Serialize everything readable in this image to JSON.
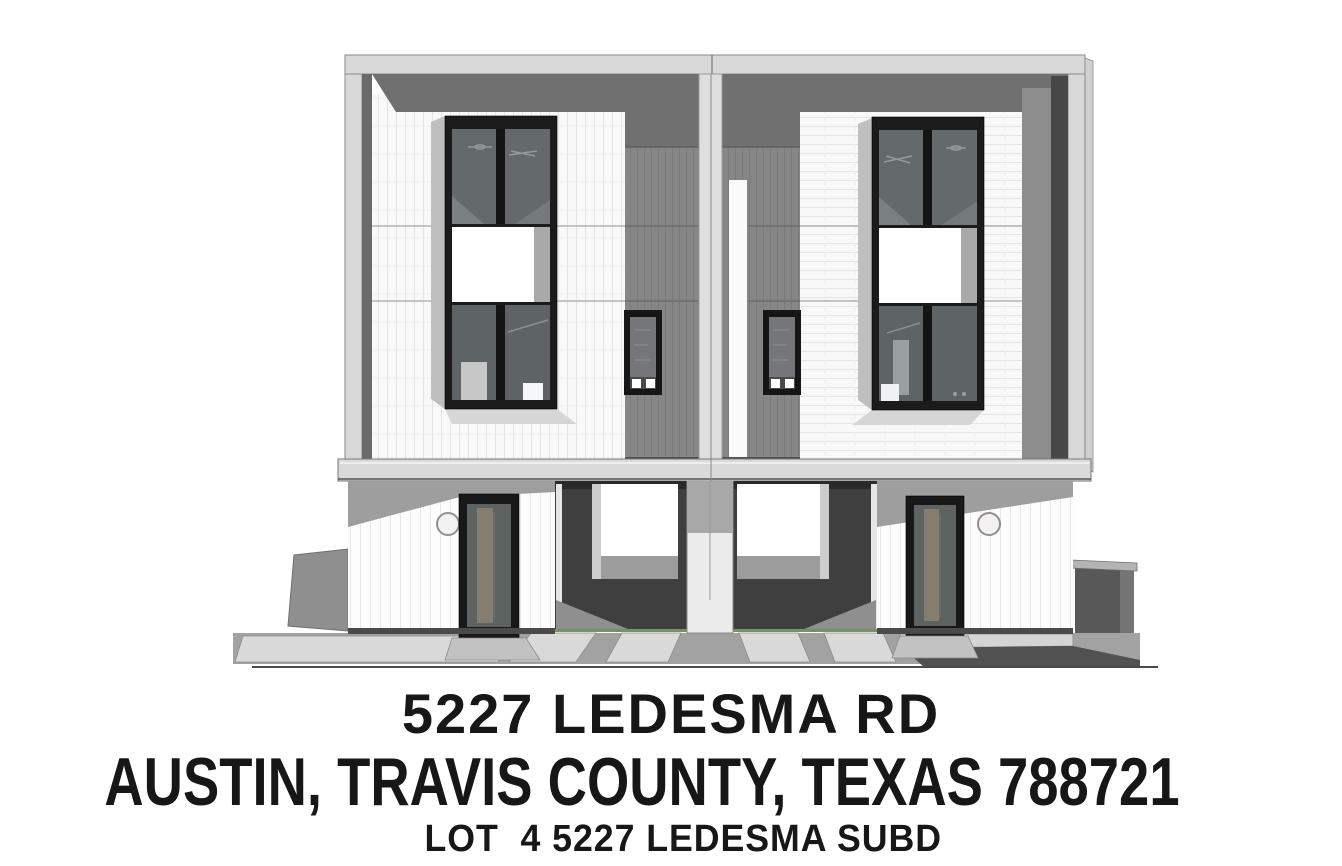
{
  "listing": {
    "address_line1": "5227 LEDESMA RD",
    "address_line2": "AUSTIN, TRAVIS COUNTY, TEXAS 788721",
    "address_line3": "LOT  4 5227 LEDESMA SUBD"
  },
  "rendering": {
    "label": "Front elevation rendering of a modern three-story duplex with center carport breezeway",
    "units_visible": 2
  },
  "colors": {
    "text": "#171717",
    "page_bg": "#ffffff",
    "frame_light": "#d8d8d8",
    "soffit_dark": "#707070",
    "panel_gray": "#868686",
    "wall_white": "#f8f8f8",
    "window_frame": "#1b1b1b",
    "glass_dark": "#646a6c",
    "carport_dark": "#3f3f3f",
    "ground_gray": "#a2a2a2"
  }
}
